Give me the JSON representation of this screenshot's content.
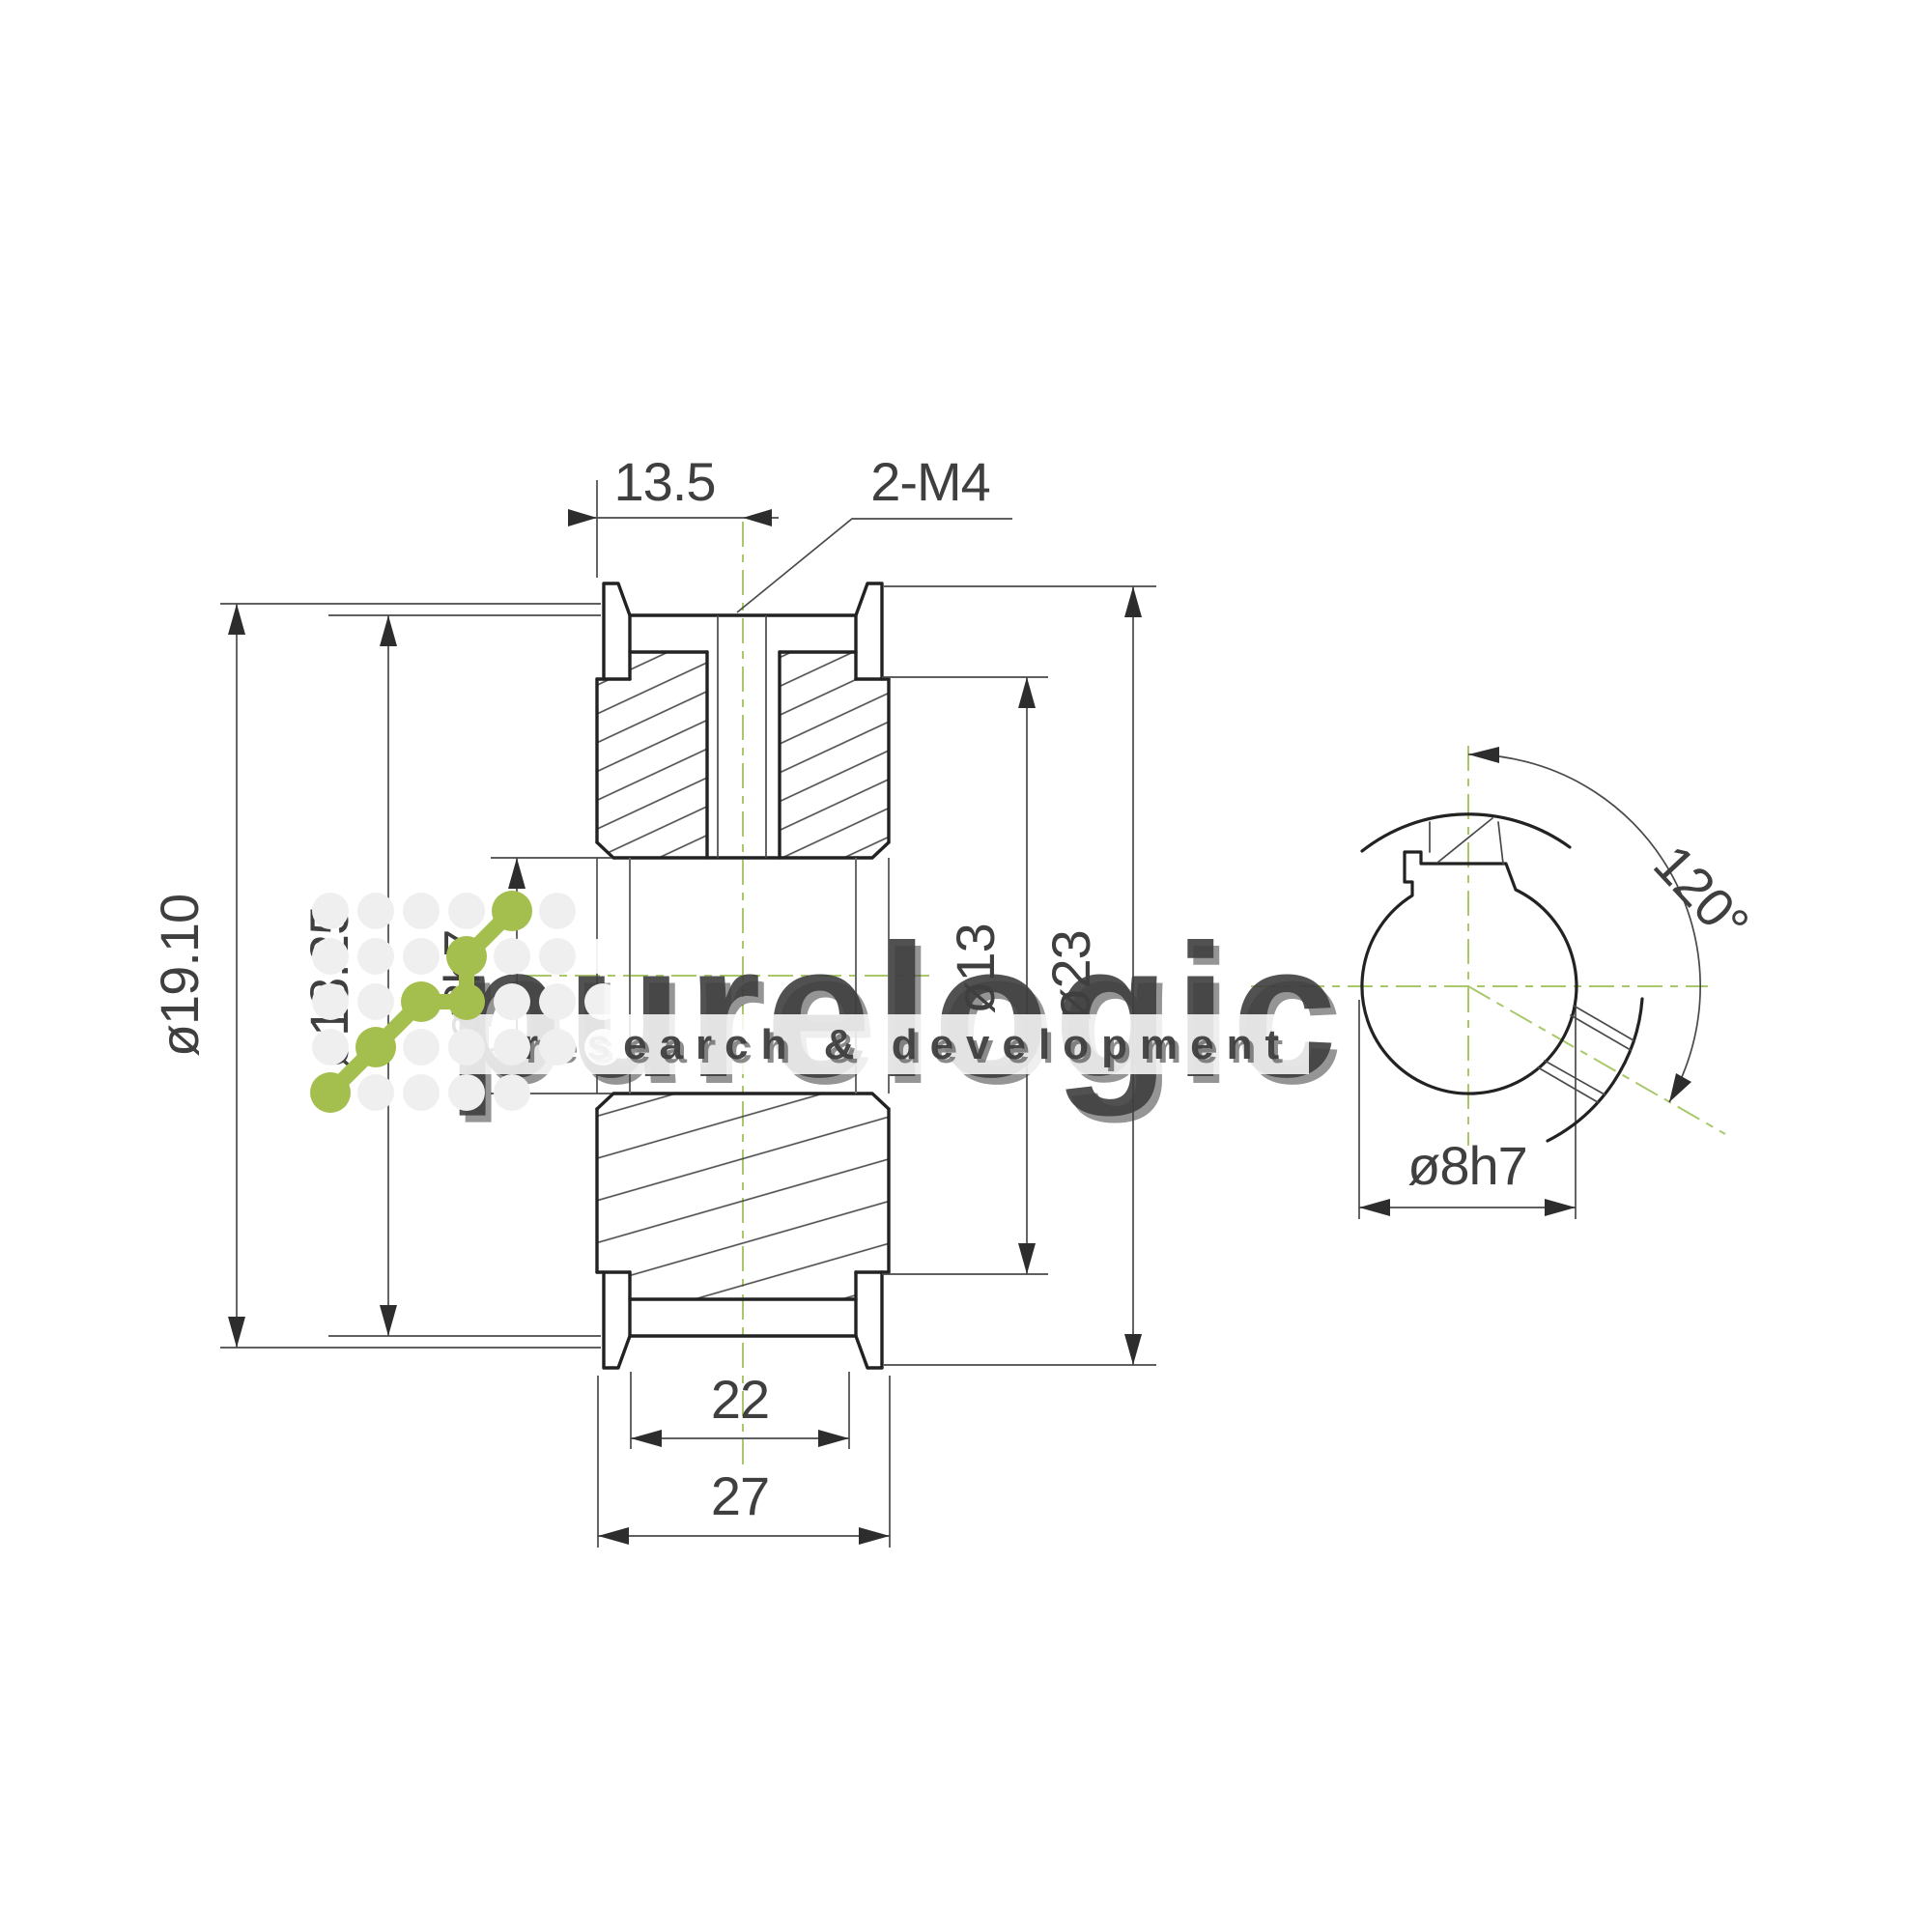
{
  "drawing": {
    "type": "engineering-drawing",
    "part": "timing belt pulley with flanges, keyed bore and two set screws",
    "dims": {
      "top_width": "13.5",
      "thread_callout": "2-M4",
      "pitch_diameter": "ø19.10",
      "outside_diameter": "ø18.25",
      "bore_side": "ø8h7",
      "boss_diameter": "ø13",
      "flange_diameter": "ø23",
      "hub_width": "22",
      "overall_width": "27",
      "screw_angle": "120°",
      "bore_end": "ø8h7"
    },
    "watermark": {
      "brand": "purelogic",
      "tagline": "research & development"
    },
    "colors": {
      "accent_green": "#a5bf4e",
      "centerline_green": "#a9c86a",
      "outline_dark": "#222222",
      "thin_line": "#4a4a4a"
    }
  }
}
